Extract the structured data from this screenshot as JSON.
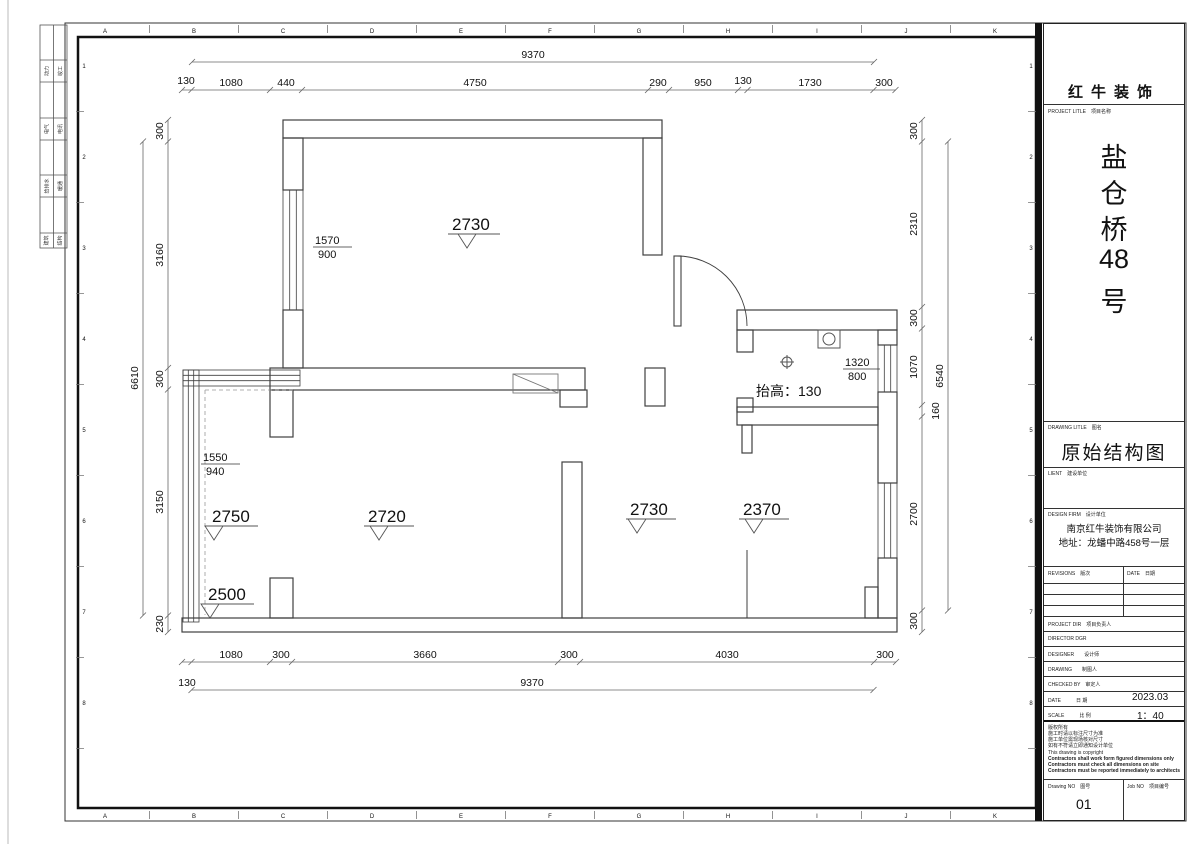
{
  "sheet": {
    "grid_letters": [
      "A",
      "B",
      "C",
      "D",
      "E",
      "F",
      "G",
      "H",
      "I",
      "J",
      "K"
    ],
    "grid_numbers": [
      "1",
      "2",
      "3",
      "4",
      "5",
      "6",
      "7",
      "8"
    ],
    "sig_rows": [
      [
        "动力",
        "竣工"
      ],
      [
        "电气",
        "电讯"
      ],
      [
        "给排水",
        "暖通"
      ],
      [
        "建筑",
        "结构"
      ]
    ]
  },
  "plan": {
    "dims": {
      "top_total": "9370",
      "top": [
        "130",
        "1080",
        "440",
        "4750",
        "290",
        "950",
        "130",
        "1730",
        "300"
      ],
      "bottom": [
        "1080",
        "300",
        "3660",
        "300",
        "4030",
        "300"
      ],
      "bottom_left": "130",
      "bottom_total": "9370",
      "left": [
        "300",
        "3160",
        "300",
        "3150",
        "230"
      ],
      "left_total": "6610",
      "right": [
        "300",
        "2310",
        "300",
        "1070",
        "2700",
        "300"
      ],
      "right_small": "160",
      "right_total": "6540"
    },
    "levels": [
      "2730",
      "2750",
      "2500",
      "2720",
      "2730",
      "2370"
    ],
    "windows": [
      {
        "w": "1570",
        "h": "900"
      },
      {
        "w": "1550",
        "h": "940"
      },
      {
        "w": "1320",
        "h": "800"
      }
    ],
    "bath_note": "抬高：130"
  },
  "title_block": {
    "company_name": "红牛装饰",
    "project_label": "PROJECT LITLE　项目名称",
    "project_name_chars": [
      "盐",
      "仓",
      "桥",
      "48",
      "号"
    ],
    "drawing_label": "DRAWING LITLE　图名",
    "drawing_title": "原始结构图",
    "client_label": "LIENT　建设单位",
    "design_firm_label": "DESIGN FIRM　设计单位",
    "design_firm_name": "南京红牛装饰有限公司",
    "design_firm_address": "地址：龙蟠中路458号一层",
    "revisions_label": "REVISIONS　版次",
    "date_col_label": "DATE　日期",
    "project_dir_label": "PROJECT DIR　项目负责人",
    "director_label": "DIRECTOR DGR",
    "designer_label": "DESIGNER　　设计师",
    "drawing_by_label": "DRAWING　　制图人",
    "checked_label": "CHECKED BY　审定人",
    "date_label": "DATE　　　日  期",
    "date_value": "2023.03",
    "scale_label": "SCALE　　　比  例",
    "scale_value": "1：40",
    "notes": [
      "版权所有",
      "施工时请以标注尺寸为准",
      "施工单位需现场核对尺寸",
      "如有不符请立即通知设计单位",
      "This drawing is copyright",
      "Contractors shall work form figured dimensions only",
      "Contractors must check all dimensions on site",
      "Contractors must be reported immediately to architects"
    ],
    "drawing_no_label": "Drawing NO　图号",
    "drawing_no_value": "01",
    "job_no_label": "Job NO　项目编号"
  }
}
